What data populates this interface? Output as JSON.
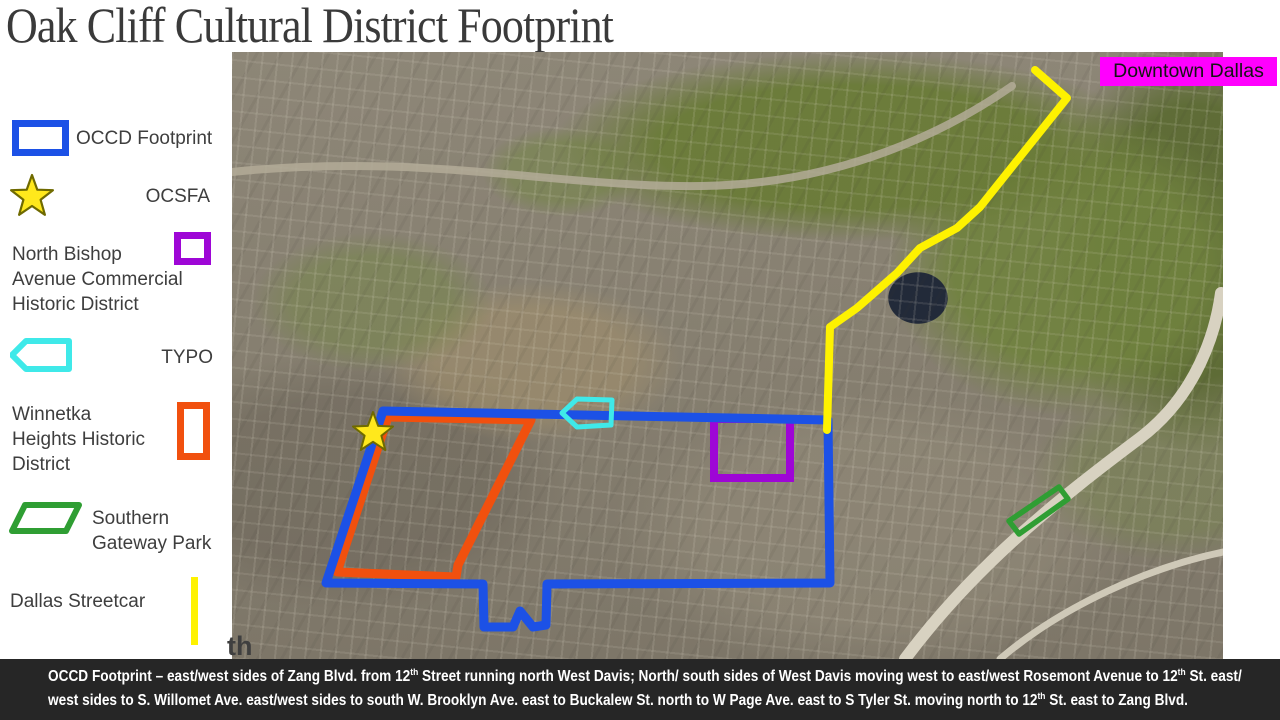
{
  "title": "Oak Cliff Cultural District Footprint",
  "legend": {
    "items": [
      {
        "id": "occd-footprint",
        "label": "OCCD Footprint",
        "swatch": "rectangle-outline",
        "color": "#1c51e6"
      },
      {
        "id": "ocsfa",
        "label": "OCSFA",
        "swatch": "star",
        "color": "#ffe81c"
      },
      {
        "id": "north-bishop",
        "label": "North Bishop\nAvenue Commercial\nHistoric District",
        "swatch": "square-outline",
        "color": "#9e06d6"
      },
      {
        "id": "typo",
        "label": "TYPO",
        "swatch": "left-arrow-outline",
        "color": "#3fe9e9"
      },
      {
        "id": "winnetka-heights",
        "label": "Winnetka\nHeights Historic\nDistrict",
        "swatch": "tall-rectangle-outline",
        "color": "#f1500e"
      },
      {
        "id": "southern-gateway",
        "label": "Southern\nGateway Park",
        "swatch": "parallelogram-outline",
        "color": "#2f9e33"
      },
      {
        "id": "dallas-streetcar",
        "label": "Dallas Streetcar",
        "swatch": "vertical-line",
        "color": "#fef200"
      }
    ]
  },
  "map": {
    "downtown_label": "Downtown Dallas",
    "downtown_label_bg": "#ff00fe",
    "corner_fragment": "th",
    "overlays": [
      {
        "name": "occd-footprint-outline",
        "color": "#1c51e6"
      },
      {
        "name": "winnetka-heights-outline",
        "color": "#f1500e"
      },
      {
        "name": "north-bishop-outline",
        "color": "#9e06d6"
      },
      {
        "name": "typo-arrow",
        "color": "#3fe9e9"
      },
      {
        "name": "ocsfa-star",
        "color": "#ffe81c"
      },
      {
        "name": "southern-gateway-outline",
        "color": "#2f9e33"
      },
      {
        "name": "streetcar-line",
        "color": "#fef200"
      }
    ]
  },
  "caption": {
    "background": "#262626",
    "lines": [
      [
        {
          "t": "OCCD Footprint – east/west sides of Zang Blvd. from 12"
        },
        {
          "sup": "th"
        },
        {
          "t": " Street running north West Davis; North/ south sides of West Davis moving west to east/west Rosemont Avenue to 12"
        },
        {
          "sup": "th"
        },
        {
          "t": " St. east/"
        }
      ],
      [
        {
          "t": "west sides to S. Willomet Ave. east/west sides to south W. Brooklyn Ave. east to Buckalew St. north to W Page Ave. east to S Tyler St. moving north to 12"
        },
        {
          "sup": "th"
        },
        {
          "t": " St. east to Zang Blvd."
        }
      ]
    ]
  }
}
